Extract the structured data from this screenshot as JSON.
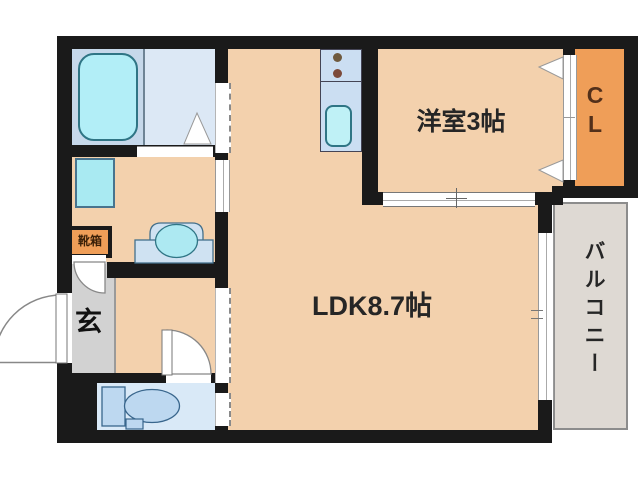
{
  "title": "apartment-floor-plan",
  "rooms": {
    "ldk": {
      "label": "LDK8.7帖"
    },
    "western_room": {
      "label": "洋室3帖"
    },
    "closet": {
      "label": "CL"
    },
    "balcony": {
      "label": "バルコニー"
    },
    "entrance": {
      "label": "玄"
    },
    "shoe_box": {
      "label": "靴箱"
    }
  },
  "fixtures": [
    "bathtub",
    "washroom-folding-door",
    "washing-machine-pan",
    "vanity-basin",
    "kitchen-counter",
    "kitchen-burners",
    "kitchen-sink",
    "toilet",
    "entrance-door",
    "hall-door",
    "genkan-door",
    "closet-sliding-door",
    "western-room-sliding-door",
    "balcony-window"
  ],
  "colors": {
    "wall": "#1a1a1a",
    "room_floor": "#f3d1ad",
    "closet_fill": "#ef9e58",
    "shoe_box_fill": "#ef9e58",
    "bathroom_floor": "#c6d8ea",
    "washroom_floor": "#dce8f5",
    "toilet_floor": "#d9e9f7",
    "entrance_floor": "#d2d2d2",
    "balcony_floor": "#ded9d3",
    "fixture_cyan": "#b2eef7",
    "fixture_cyan_border": "#2f7585",
    "fixture_blue": "#bdd8f0",
    "fixture_blue_border": "#39668c",
    "kitchen_fill": "#cbdef2",
    "label_text": "#262626",
    "closet_text": "#53301a"
  }
}
